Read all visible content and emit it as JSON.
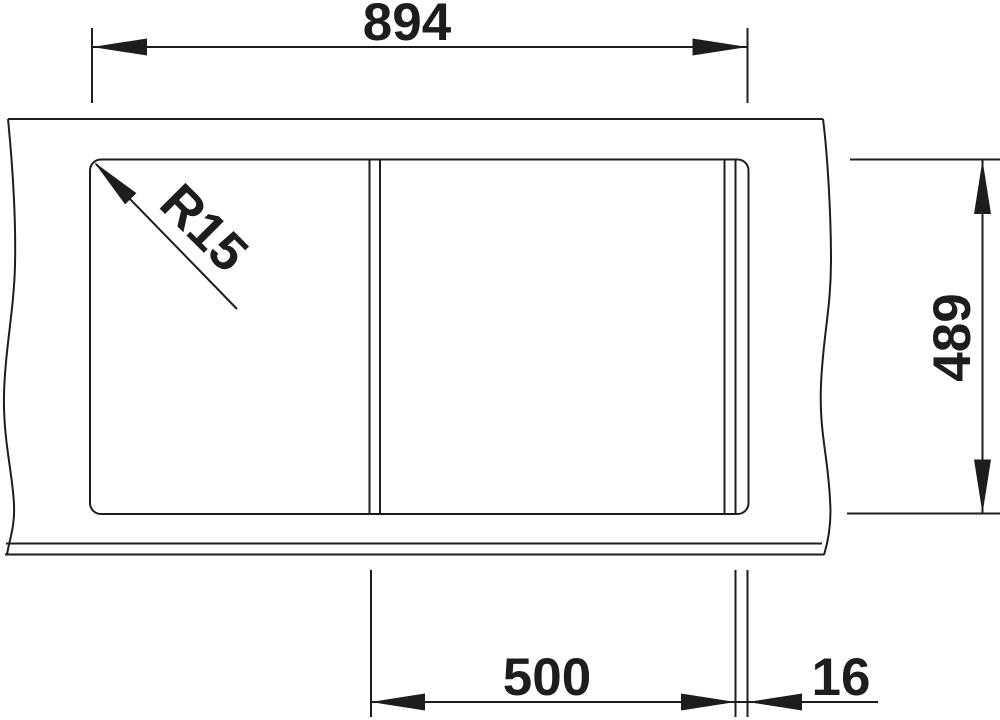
{
  "drawing": {
    "description": "sink-top-view-technical-drawing",
    "colors": {
      "line": "#1d1d1b",
      "background": "#ffffff"
    },
    "labels": {
      "dim_top": "894",
      "dim_right": "489",
      "dim_bottom_left": "500",
      "dim_bottom_right": "16",
      "radius": "R15"
    }
  }
}
